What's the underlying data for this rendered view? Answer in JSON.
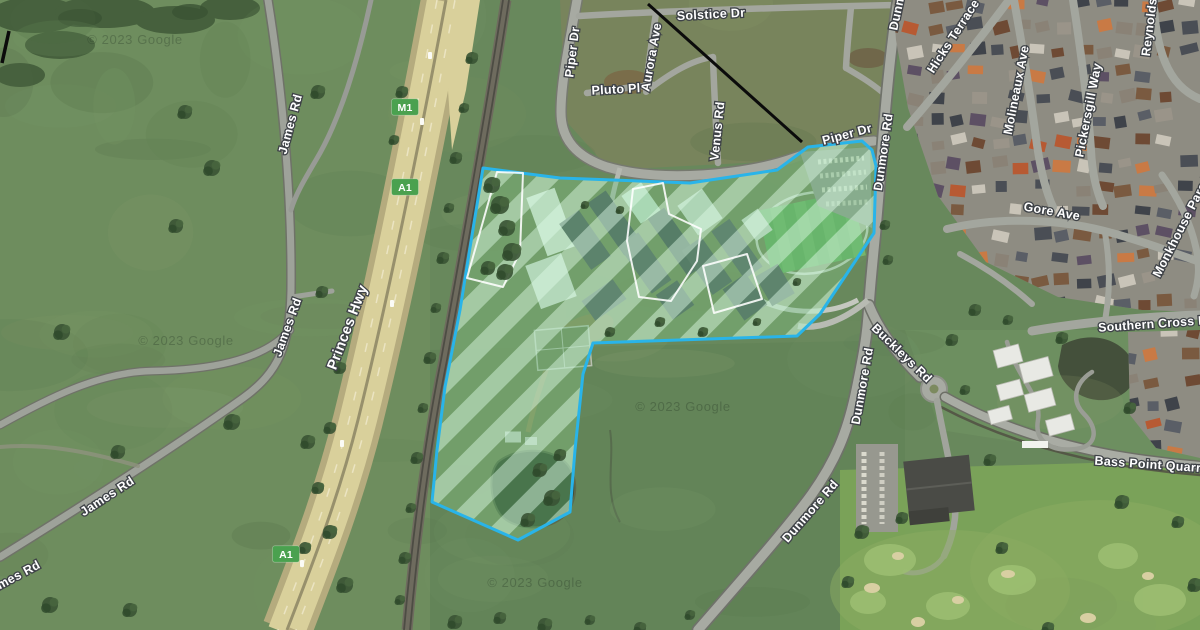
{
  "map": {
    "type": "satellite-imagery",
    "attribution_text": "© 2023 Google",
    "watermarks": [
      {
        "x": 135,
        "y": 44
      },
      {
        "x": 186,
        "y": 345
      },
      {
        "x": 683,
        "y": 411
      },
      {
        "x": 535,
        "y": 587
      }
    ],
    "route_shields": [
      {
        "label": "M1",
        "x": 405,
        "y": 107,
        "color": "#4aa14f"
      },
      {
        "label": "A1",
        "x": 405,
        "y": 187,
        "color": "#4aa14f"
      },
      {
        "label": "A1",
        "x": 286,
        "y": 554,
        "color": "#4aa14f"
      }
    ],
    "road_labels": [
      {
        "text": "Solstice Dr",
        "x": 711,
        "y": 14,
        "rot": -3,
        "size": 12.5
      },
      {
        "text": "Piper Dr",
        "x": 572,
        "y": 52,
        "rot": -83,
        "size": 12.5
      },
      {
        "text": "Aurora Ave",
        "x": 651,
        "y": 57,
        "rot": -80,
        "size": 12.5
      },
      {
        "text": "Pluto Pl",
        "x": 616,
        "y": 89,
        "rot": -3,
        "size": 12.5
      },
      {
        "text": "Venus Rd",
        "x": 717,
        "y": 131,
        "rot": -84,
        "size": 12.5
      },
      {
        "text": "Piper Dr",
        "x": 847,
        "y": 134,
        "rot": -15,
        "size": 12.5
      },
      {
        "text": "Dunmore Rd",
        "x": 901,
        "y": -8,
        "rot": -78,
        "size": 12.5
      },
      {
        "text": "Hicks Terrace",
        "x": 953,
        "y": 36,
        "rot": -57,
        "size": 12.5
      },
      {
        "text": "Molineaux Ave",
        "x": 1016,
        "y": 90,
        "rot": -79,
        "size": 12.5
      },
      {
        "text": "Pickersgill Way",
        "x": 1088,
        "y": 110,
        "rot": -79,
        "size": 12.5
      },
      {
        "text": "Reynolds",
        "x": 1149,
        "y": 27,
        "rot": -83,
        "size": 12.5
      },
      {
        "text": "Gore Ave",
        "x": 1052,
        "y": 211,
        "rot": 10,
        "size": 12.5
      },
      {
        "text": "Monkhouse Parade",
        "x": 1183,
        "y": 223,
        "rot": -63,
        "size": 12.5
      },
      {
        "text": "Southern Cross Blvd",
        "x": 1162,
        "y": 323,
        "rot": -4,
        "size": 12.3
      },
      {
        "text": "Dunmore Rd",
        "x": 883,
        "y": 152,
        "rot": -82,
        "size": 12.5
      },
      {
        "text": "Dunmore Rd",
        "x": 862,
        "y": 386,
        "rot": -80,
        "size": 12.5
      },
      {
        "text": "Buckleys Rd",
        "x": 902,
        "y": 353,
        "rot": 44,
        "size": 12.5
      },
      {
        "text": "Dunmore Rd",
        "x": 810,
        "y": 511,
        "rot": -49,
        "size": 12.5
      },
      {
        "text": "Bass Point Quarry Rd",
        "x": 1162,
        "y": 465,
        "rot": 4,
        "size": 12.5
      },
      {
        "text": "James Rd",
        "x": 290,
        "y": 124,
        "rot": -75,
        "size": 12.5
      },
      {
        "text": "James Rd",
        "x": 287,
        "y": 327,
        "rot": -70,
        "size": 12.5
      },
      {
        "text": "James Rd",
        "x": 107,
        "y": 496,
        "rot": -33,
        "size": 12.5
      },
      {
        "text": "James Rd",
        "x": 12,
        "y": 578,
        "rot": -28,
        "size": 12.5
      },
      {
        "text": "Princes Hwy",
        "x": 347,
        "y": 327,
        "rot": -69,
        "size": 14.5
      }
    ],
    "parcel": {
      "stroke_color": "#29b4e9",
      "hatch_base": "rgba(97,199,123,0.34)",
      "hatch_light": "rgba(224,252,232,0.45)",
      "outer": [
        [
          483,
          168
        ],
        [
          560,
          178
        ],
        [
          690,
          183
        ],
        [
          777,
          170
        ],
        [
          808,
          147
        ],
        [
          862,
          141
        ],
        [
          872,
          150
        ],
        [
          876,
          166
        ],
        [
          874,
          233
        ],
        [
          846,
          275
        ],
        [
          820,
          314
        ],
        [
          797,
          336
        ],
        [
          593,
          343
        ],
        [
          583,
          374
        ],
        [
          575,
          450
        ],
        [
          570,
          512
        ],
        [
          518,
          540
        ],
        [
          432,
          502
        ],
        [
          437,
          450
        ],
        [
          445,
          387
        ],
        [
          460,
          310
        ],
        [
          468,
          260
        ]
      ],
      "inner": [
        [
          [
            497,
            172
          ],
          [
            523,
            173
          ],
          [
            520,
            252
          ],
          [
            503,
            287
          ],
          [
            467,
            278
          ]
        ],
        [
          [
            633,
            189
          ],
          [
            663,
            183
          ],
          [
            669,
            214
          ],
          [
            701,
            229
          ],
          [
            697,
            261
          ],
          [
            671,
            301
          ],
          [
            639,
            297
          ],
          [
            627,
            241
          ]
        ],
        [
          [
            703,
            266
          ],
          [
            747,
            254
          ],
          [
            762,
            299
          ],
          [
            714,
            313
          ]
        ]
      ]
    },
    "annotation_lines": [
      {
        "x1": 648,
        "y1": 4,
        "x2": 802,
        "y2": 142,
        "w": 3
      },
      {
        "x1": 9,
        "y1": 31,
        "x2": 2,
        "y2": 63,
        "w": 3.5
      }
    ]
  }
}
